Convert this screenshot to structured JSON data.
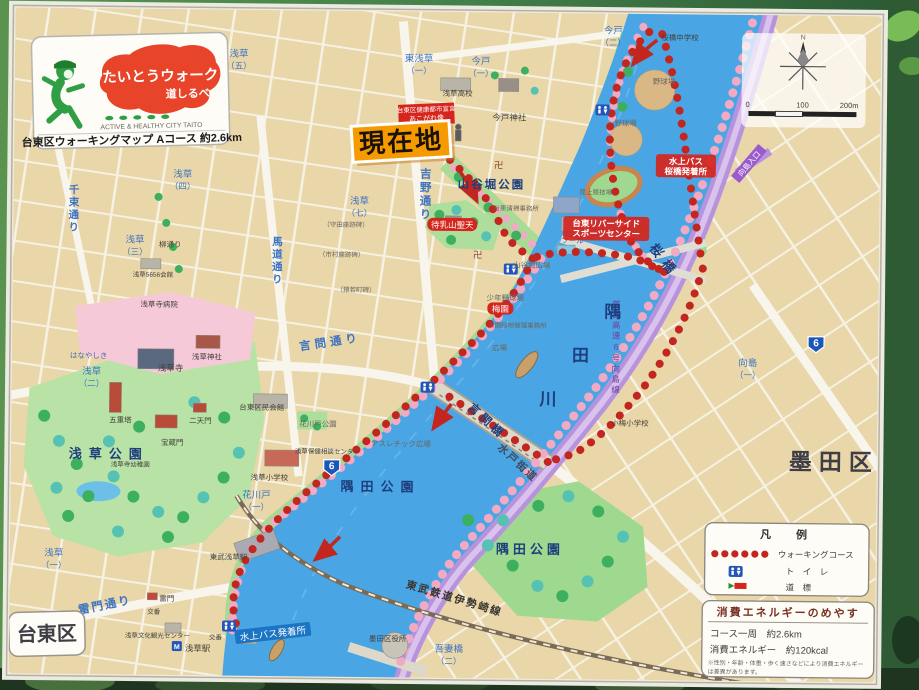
{
  "sign": {
    "badge": {
      "title": "たいとうウォーク",
      "subtitle": "道しるべ",
      "tagline": "ACTIVE & HEALTHY CITY TAITO",
      "course_info": "台東区ウォーキングマップ Aコース 約2.6km"
    },
    "current_location": "現在地",
    "declaration_l1": "台東区健康都市宣言",
    "declaration_l2": "あこがれ像"
  },
  "compass": {
    "north": "N",
    "ticks": [
      "0",
      "100",
      "200m"
    ]
  },
  "legend": {
    "title": "凡　例",
    "walking_course": "ウォーキングコース",
    "toilet": "ト　イ　レ",
    "signpost": "道　標"
  },
  "energy": {
    "title": "消費エネルギーのめやす",
    "course_distance": "コース一周　約2.6km",
    "calories": "消費エネルギー　約120kcal",
    "note_l1": "※性別・年齢・体重・歩く速さなどにより消費エネルギー",
    "note_l2": "は差異があります。"
  },
  "map": {
    "wards": {
      "taito": "台東区",
      "sumida": "墨田区"
    },
    "river_chars": [
      "隅",
      "田",
      "川"
    ],
    "bridges": {
      "sakura": "桜橋",
      "kototoi": "言問橋",
      "azuma_l1": "吾妻橋",
      "azuma_l2": "（二）"
    },
    "rail": {
      "tobu_isesaki": "東武鉄道伊勢崎線"
    },
    "roads": {
      "yoshino": "吉野通り",
      "umamichi": "馬道通り",
      "senzoku": "千束通り",
      "kototoi": "言問通り",
      "kaminarimon": "雷門通り",
      "yanagi": "柳通り",
      "mito_kaido": "水戸街道",
      "expressway": "首都高速6号向島線",
      "mukojima_entrance": "向島入口",
      "route6": "6"
    },
    "parks": {
      "asakusa": "浅草公園",
      "sumida_left": "隅田公園",
      "sumida_right": "隅田公園",
      "sanyabori": "山谷堀公園",
      "hanakawado": "花川戸公園",
      "hanayashiki": "はなやしき",
      "sanyabori_square": "山谷堀広場",
      "plaza": "広場",
      "athletic": "アスレチック広場"
    },
    "temples": {
      "sensoji": "浅草寺",
      "asakusa_jinja": "浅草神社",
      "gojunoto": "五重塔",
      "hozomon": "宝蔵門",
      "nitenmon": "二天門",
      "imado_jinja": "今戸神社",
      "matsuchiyama": "待乳山聖天",
      "manji": "卍"
    },
    "facilities": {
      "riverside_l1": "台東リバーサイド",
      "riverside_l2": "スポーツセンター",
      "track": "陸上競技場",
      "ballpark1": "野球場",
      "ballpark2": "野球場",
      "pool": "プール",
      "sakurabashi_jhs": "桜橋中学校",
      "asakusa_hs": "浅草高校",
      "koume_es": "小梅小学校",
      "asakusa_es": "浅草小学校",
      "sensoji_hospital": "浅草寺病院",
      "sensoji_kindergarten": "浅草寺幼稚園",
      "asakusa5656": "浅草5656会館",
      "taito_kumin": "台東区民会館",
      "hoken_center": "浅草保健相談センター",
      "park_admin": "公園緑地管理事務所",
      "taito_seiso": "台東清掃事務所",
      "shonen_ballpark": "少年野球場",
      "sumida_office": "墨田区役所",
      "bunka_center": "浅草文化観光センター",
      "koban1": "交番",
      "koban2": "交番",
      "kaminarimon_gate": "雷門",
      "baien": "梅園"
    },
    "stations": {
      "tobu_asakusa": "東武浅草駅",
      "asakusa": "浅草駅"
    },
    "piers": {
      "sakurabashi_l1": "水上バス",
      "sakurabashi_l2": "桜橋発着所",
      "suijo_bus": "水上バス発着所"
    },
    "monuments": {
      "morita": "（守田座跡碑）",
      "ichimura": "（市村座跡碑）",
      "saruwaka": "（猿若町碑）"
    },
    "districts": {
      "higashi_asakusa1_l1": "東浅草",
      "higashi_asakusa1_l2": "（一）",
      "imado1_l1": "今戸",
      "imado1_l2": "（一）",
      "imado2_l1": "今戸",
      "imado2_l2": "（二）",
      "asakusa5_l1": "浅草",
      "asakusa5_l2": "（五）",
      "asakusa4_l1": "浅草",
      "asakusa4_l2": "（四）",
      "asakusa3_l1": "浅草",
      "asakusa3_l2": "（三）",
      "asakusa7_l1": "浅草",
      "asakusa7_l2": "（七）",
      "asakusa2_l1": "浅草",
      "asakusa2_l2": "（二）",
      "asakusa1_l1": "浅草",
      "asakusa1_l2": "（一）",
      "hanakawado1_l1": "花川戸",
      "hanakawado1_l2": "（一）",
      "mukojima1_l1": "向島",
      "mukojima1_l2": "（一）"
    },
    "colors": {
      "course_red": "#c3261f",
      "river_blue": "#49a5e3",
      "park_green": "#a5da96",
      "expressway_purple": "#b893dd",
      "location_orange": "#f59b00"
    }
  }
}
